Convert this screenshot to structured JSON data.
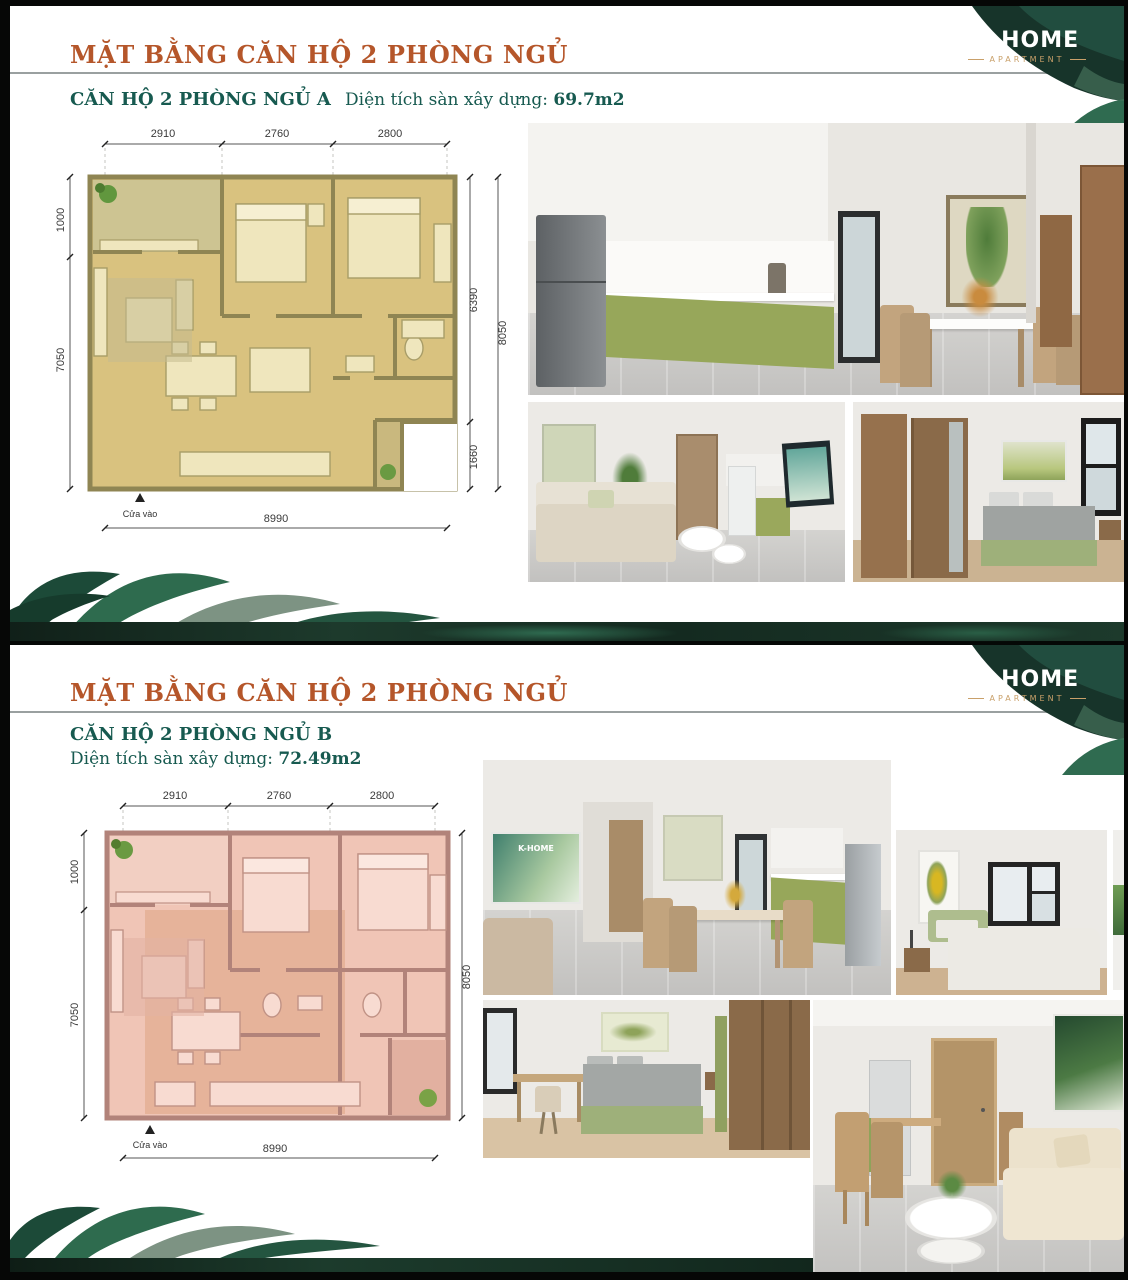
{
  "brand": {
    "name": "K-HOME",
    "tagline": "APARTMENT"
  },
  "colors": {
    "title_orange": "#b5562a",
    "heading_teal": "#175a50",
    "leaf_dark": "#17342a",
    "leaf_mid": "#2e6b4e",
    "plan_a_fill": "#d9c27f",
    "plan_a_wall": "#8f8553",
    "plan_b_fill": "#f0c5b6",
    "plan_b_wall": "#b2837a",
    "kitchen_cabinet_green": "#97a75a"
  },
  "panels": [
    {
      "title": "MẶT BẰNG CĂN HỘ 2 PHÒNG NGỦ",
      "unit_name": "CĂN HỘ 2 PHÒNG NGỦ A",
      "area_label": "Diện tích sàn xây dựng:",
      "area_value": "69.7m2",
      "floorplan": {
        "dims_top": [
          "2910",
          "2760",
          "2800"
        ],
        "dim_left_top": "1000",
        "dim_left_total": "7050",
        "dim_right_upper": "6390",
        "dim_right_lower": "1660",
        "dim_right_total": "8050",
        "dim_bottom": "8990",
        "entrance_label": "Cửa vào"
      }
    },
    {
      "title": "MẶT BẰNG CĂN HỘ 2 PHÒNG NGỦ",
      "unit_name": "CĂN HỘ 2 PHÒNG NGỦ B",
      "area_label": "Diện tích sàn xây dựng:",
      "area_value": "72.49m2",
      "floorplan": {
        "dims_top": [
          "2910",
          "2760",
          "2800"
        ],
        "dim_left_top": "1000",
        "dim_left_total": "7050",
        "dim_right_total": "8050",
        "dim_bottom": "8990",
        "entrance_label": "Cửa vào"
      }
    }
  ]
}
